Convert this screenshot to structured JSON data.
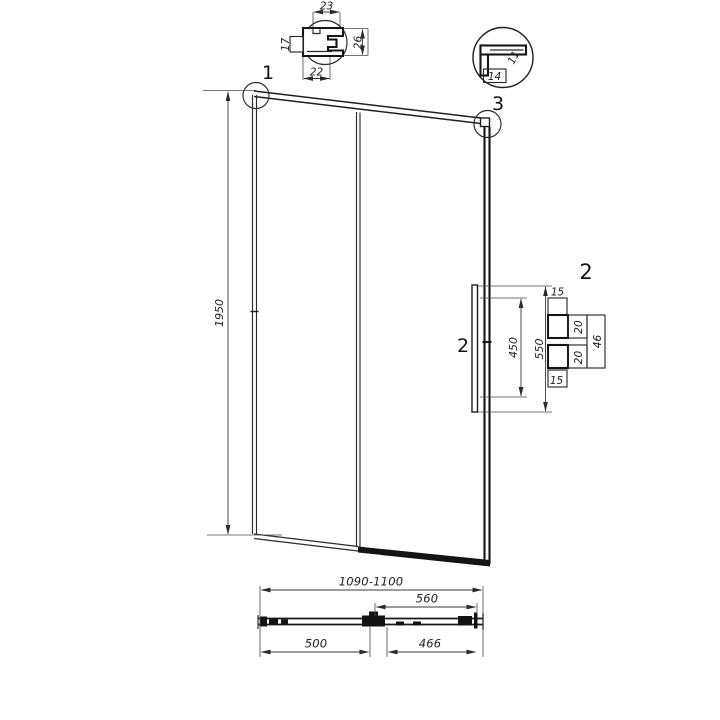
{
  "callouts": {
    "top_left_corner": "1",
    "top_right_corner": "3",
    "handle_side": "2",
    "handle_detail": "2"
  },
  "profile_detail": {
    "top_width": "23",
    "bottom_width": "22",
    "height": "26",
    "side": "17"
  },
  "corner_detail": {
    "bottom_width": "14",
    "side_width": "11"
  },
  "elevation": {
    "height": "1950"
  },
  "handle_detail": {
    "hole_spacing": "450",
    "handle_length": "550",
    "top_offset": "15",
    "upper_block": "20",
    "lower_block": "20",
    "bottom_offset": "15",
    "depth": "46"
  },
  "plan": {
    "overall_width": "1090-1100",
    "sliding_panel_width": "560",
    "fixed_panel_width": "500",
    "opening_width": "466"
  },
  "colors": {
    "line": "#1f1f1f",
    "background": "#ffffff"
  }
}
